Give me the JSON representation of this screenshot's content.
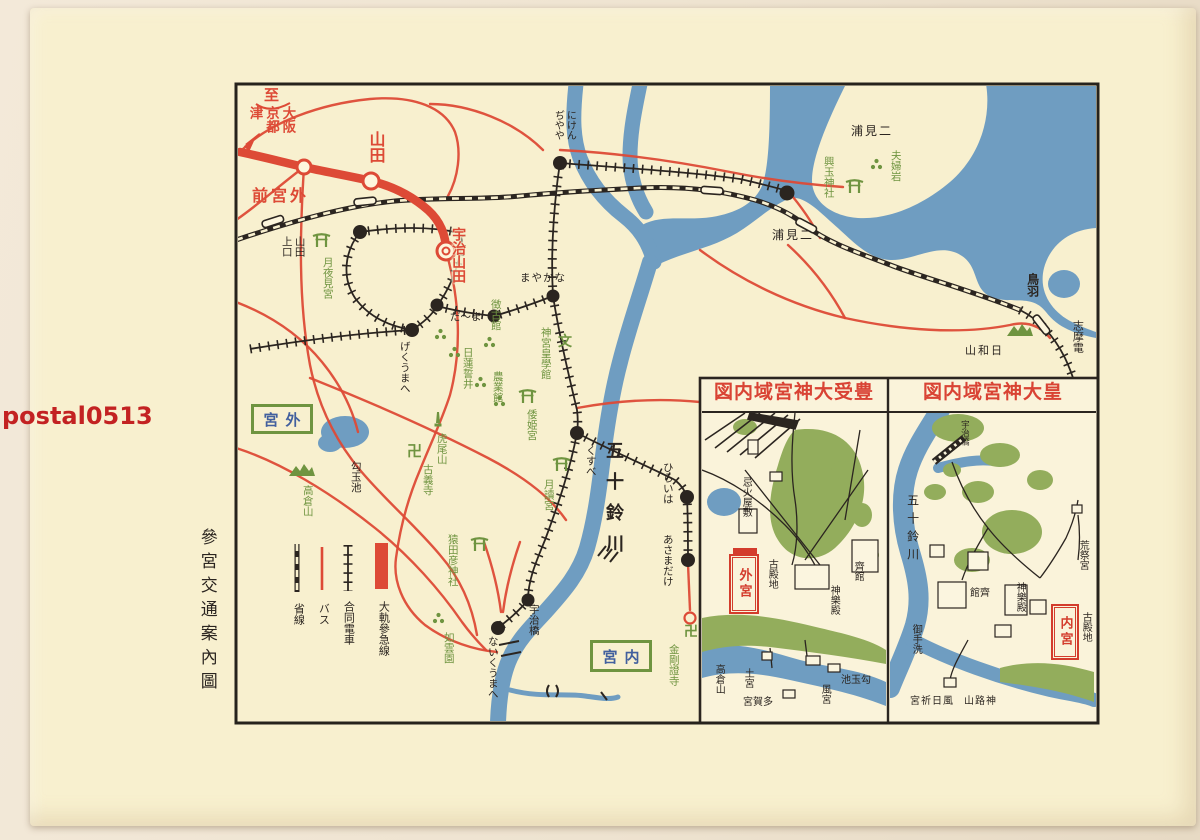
{
  "colors": {
    "black": "#2b2520",
    "red": "#dd4a36",
    "redlbl": "#d33c2c",
    "redtitle": "#d94334",
    "green": "#6f9440",
    "parkgreen": "#93ad5c",
    "blue": "#42609e",
    "water": "#6f9dc1",
    "cream": "#f8f0cf",
    "wm": "#c32222"
  },
  "postcard": {
    "labels": [
      {
        "name": "watermark",
        "text": "postal0513",
        "x": 2,
        "y": 402,
        "m": "h",
        "c": "wm",
        "s": 24,
        "b": 1,
        "f": "sans"
      },
      {
        "name": "map-doc-title",
        "text": "參宮交通案內圖",
        "x": 196,
        "y": 528,
        "m": "v",
        "c": "black",
        "s": 17,
        "ls": 7
      }
    ]
  },
  "legend": {
    "labels": [
      {
        "name": "legend-daiki-sankyu-line",
        "text": "大軌參急線",
        "x": 377,
        "y": 601,
        "m": "v",
        "c": "black",
        "s": 11
      },
      {
        "name": "legend-godo-densha",
        "text": "合同電車",
        "x": 342,
        "y": 601,
        "m": "v",
        "c": "black",
        "s": 11
      },
      {
        "name": "legend-bus",
        "text": "バス",
        "x": 317,
        "y": 603,
        "m": "v",
        "c": "black",
        "s": 11
      },
      {
        "name": "legend-shosen",
        "text": "省線",
        "x": 292,
        "y": 603,
        "m": "v",
        "c": "black",
        "s": 11
      }
    ]
  },
  "main_map": {
    "labels": [
      {
        "name": "dest-to",
        "text": "至",
        "x": 264,
        "y": 86,
        "m": "h",
        "c": "red",
        "s": 15,
        "b": 1
      },
      {
        "name": "dest-osaka-kyoto-tsu",
        "text": "大阪\n京都\n津",
        "x": 246,
        "y": 106,
        "m": "v",
        "c": "red",
        "s": 13.5,
        "b": 1
      },
      {
        "name": "sta-yamada-daiki",
        "text": "山田",
        "x": 366,
        "y": 131,
        "m": "v",
        "c": "red",
        "s": 16,
        "b": 1
      },
      {
        "name": "sta-gekumae",
        "text": "前宮外",
        "x": 252,
        "y": 186,
        "m": "h",
        "c": "red",
        "s": 16,
        "b": 1,
        "ls": 3
      },
      {
        "name": "sta-ujiyamada",
        "text": "宇治山田",
        "x": 449,
        "y": 227,
        "m": "v",
        "c": "red",
        "s": 14,
        "b": 1,
        "halo": 1
      },
      {
        "name": "sta-yamada-kamiguchi",
        "text": "山田\n上口",
        "x": 280,
        "y": 236,
        "m": "v",
        "c": "black",
        "s": 10.5
      },
      {
        "name": "shrine-tsukiyominomiya",
        "text": "月夜見宮",
        "x": 321,
        "y": 257,
        "m": "v",
        "c": "green",
        "s": 10.5
      },
      {
        "name": "sta-nikenjaya",
        "text": "にけん\nぢやや",
        "x": 551,
        "y": 110,
        "m": "v",
        "c": "black",
        "s": 10
      },
      {
        "name": "sta-nakayama",
        "text": "まやかな",
        "x": 520,
        "y": 272,
        "m": "h",
        "c": "black",
        "s": 10.5,
        "ls": 1
      },
      {
        "name": "sta-dama",
        "text": "だ〜ま",
        "x": 450,
        "y": 311,
        "m": "h",
        "c": "black",
        "s": 10.5
      },
      {
        "name": "sta-gekuumae-kana",
        "text": "げくうまへ",
        "x": 398,
        "y": 341,
        "m": "v",
        "c": "black",
        "s": 10.5
      },
      {
        "name": "poi-chokokan",
        "text": "徴古館",
        "x": 489,
        "y": 299,
        "m": "v",
        "c": "green",
        "s": 10.5
      },
      {
        "name": "poi-jingu-kogakkan",
        "text": "神宮皇學館",
        "x": 539,
        "y": 327,
        "m": "v",
        "c": "green",
        "s": 10.5
      },
      {
        "name": "icon-school-mark",
        "text": "文",
        "x": 558,
        "y": 334,
        "m": "h",
        "c": "green",
        "s": 14,
        "b": 1
      },
      {
        "name": "poi-nichiren-well",
        "text": "日蓮誓井",
        "x": 461,
        "y": 347,
        "m": "v",
        "c": "green",
        "s": 10.5
      },
      {
        "name": "poi-nogyokan",
        "text": "農業館",
        "x": 491,
        "y": 371,
        "m": "v",
        "c": "green",
        "s": 10.5
      },
      {
        "name": "shrine-yamatohime",
        "text": "倭姫宮",
        "x": 525,
        "y": 409,
        "m": "v",
        "c": "green",
        "s": 10.5
      },
      {
        "name": "shrine-tsukiyomi-naiku",
        "text": "月讀宮",
        "x": 542,
        "y": 479,
        "m": "v",
        "c": "green",
        "s": 10.5
      },
      {
        "name": "sta-kusube",
        "text": "くすべ",
        "x": 584,
        "y": 445,
        "m": "v",
        "c": "black",
        "s": 10.5
      },
      {
        "name": "river-isuzu-label",
        "text": "五十鈴川",
        "x": 602,
        "y": 441,
        "m": "v",
        "c": "black",
        "s": 18,
        "ls": 13,
        "b": 1
      },
      {
        "name": "sta-hiraiwa",
        "text": "ひらいは",
        "x": 661,
        "y": 462,
        "m": "v",
        "c": "black",
        "s": 10.5
      },
      {
        "name": "sta-asamadake",
        "text": "あさまだけ",
        "x": 661,
        "y": 534,
        "m": "v",
        "c": "black",
        "s": 10.5
      },
      {
        "name": "poi-toraoyama",
        "text": "虎尾山",
        "x": 435,
        "y": 433,
        "m": "v",
        "c": "green",
        "s": 10.5
      },
      {
        "name": "manji-kogiji",
        "text": "卍",
        "x": 407,
        "y": 442,
        "m": "h",
        "c": "green",
        "s": 15,
        "b": 1
      },
      {
        "name": "temple-kogiji",
        "text": "古義寺",
        "x": 421,
        "y": 464,
        "m": "v",
        "c": "green",
        "s": 10.5
      },
      {
        "name": "pond-magatamaike",
        "text": "勾玉池",
        "x": 349,
        "y": 461,
        "m": "v",
        "c": "black",
        "s": 10.5
      },
      {
        "name": "mtn-takakurayama",
        "text": "高倉山",
        "x": 301,
        "y": 485,
        "m": "v",
        "c": "green",
        "s": 10.5
      },
      {
        "name": "shrine-sarutahiko",
        "text": "猿田彦神社",
        "x": 446,
        "y": 534,
        "m": "v",
        "c": "green",
        "s": 10.5
      },
      {
        "name": "garden-jounen",
        "text": "如雲園",
        "x": 442,
        "y": 632,
        "m": "v",
        "c": "green",
        "s": 10.5
      },
      {
        "name": "sta-naikumae",
        "text": "ないくうまへ",
        "x": 486,
        "y": 636,
        "m": "v",
        "c": "black",
        "s": 10.5
      },
      {
        "name": "bridge-ujibashi",
        "text": "宇治橋",
        "x": 527,
        "y": 604,
        "m": "v",
        "c": "black",
        "s": 10.5
      },
      {
        "name": "manji-kongoshoji",
        "text": "卍",
        "x": 684,
        "y": 624,
        "m": "h",
        "c": "green",
        "s": 14,
        "b": 1
      },
      {
        "name": "temple-kongoshoji",
        "text": "金剛證寺",
        "x": 667,
        "y": 644,
        "m": "v",
        "c": "green",
        "s": 10.5
      },
      {
        "name": "coast-futamiura",
        "text": "浦見二",
        "x": 851,
        "y": 124,
        "m": "h",
        "c": "black",
        "s": 12,
        "ls": 2
      },
      {
        "name": "poi-meotoiwa",
        "text": "夫婦岩",
        "x": 889,
        "y": 150,
        "m": "v",
        "c": "green",
        "s": 10.5
      },
      {
        "name": "shrine-okitama",
        "text": "興玉神社",
        "x": 822,
        "y": 156,
        "m": "v",
        "c": "green",
        "s": 10.5
      },
      {
        "name": "sta-futamiura",
        "text": "浦見二",
        "x": 772,
        "y": 228,
        "m": "h",
        "c": "black",
        "s": 12,
        "ls": 2
      },
      {
        "name": "sta-toba",
        "text": "鳥羽",
        "x": 1025,
        "y": 273,
        "m": "v",
        "c": "black",
        "s": 12,
        "b": 1
      },
      {
        "name": "line-shimaden",
        "text": "志摩電",
        "x": 1071,
        "y": 320,
        "m": "v",
        "c": "black",
        "s": 11
      },
      {
        "name": "mtn-hiyoriyama",
        "text": "山和日",
        "x": 965,
        "y": 344,
        "m": "h",
        "c": "black",
        "s": 11,
        "ls": 2
      }
    ],
    "boxes": [
      {
        "name": "box-geku",
        "x": 251,
        "y": 404,
        "w": 62,
        "h": 30,
        "style": "green",
        "text": "宮外"
      },
      {
        "name": "box-naiku",
        "x": 590,
        "y": 640,
        "w": 62,
        "h": 32,
        "style": "green",
        "text": "宮内"
      }
    ],
    "icons": [
      {
        "t": "torii",
        "x": 312,
        "y": 232,
        "name": "torii-tsukiyominomiya"
      },
      {
        "t": "torii",
        "x": 470,
        "y": 536,
        "name": "torii-sarutahiko"
      },
      {
        "t": "torii",
        "x": 518,
        "y": 388,
        "name": "torii-yamatohime"
      },
      {
        "t": "torii",
        "x": 552,
        "y": 456,
        "name": "torii-tsukiyomi"
      },
      {
        "t": "torii",
        "x": 845,
        "y": 178,
        "name": "torii-okitama"
      },
      {
        "t": "mtn",
        "x": 288,
        "y": 462,
        "name": "mountain-takakurayama"
      },
      {
        "t": "mtn",
        "x": 1006,
        "y": 322,
        "name": "mountain-hiyoriyama"
      },
      {
        "t": "monument",
        "x": 433,
        "y": 411,
        "name": "monument-toraoyama"
      },
      {
        "t": "trees",
        "x": 434,
        "y": 328,
        "name": "trees"
      },
      {
        "t": "trees",
        "x": 448,
        "y": 346,
        "name": "trees"
      },
      {
        "t": "trees",
        "x": 483,
        "y": 336,
        "name": "trees"
      },
      {
        "t": "trees",
        "x": 474,
        "y": 376,
        "name": "trees"
      },
      {
        "t": "trees",
        "x": 493,
        "y": 395,
        "name": "trees"
      },
      {
        "t": "trees",
        "x": 432,
        "y": 612,
        "name": "trees"
      },
      {
        "t": "trees",
        "x": 870,
        "y": 158,
        "name": "trees-meotoiwa"
      }
    ]
  },
  "insets": {
    "left": {
      "title_label": {
        "name": "inset-title-toyouke-daijingu",
        "text": "図内域宮神大受豊",
        "x": 714,
        "y": 381,
        "m": "h",
        "c": "redtitle",
        "s": 19,
        "b": 1,
        "ls": 1
      },
      "box": {
        "name": "box-geku-inset",
        "x": 729,
        "y": 554,
        "w": 30,
        "h": 60,
        "style": "red",
        "text": "外宮"
      },
      "labels": [
        {
          "name": "ins-l-imibi-yashiki",
          "text": "忌火屋敷",
          "x": 739,
          "y": 477,
          "m": "v",
          "c": "black",
          "s": 10
        },
        {
          "name": "ins-l-kodenchi",
          "text": "古殿地",
          "x": 765,
          "y": 559,
          "m": "v",
          "c": "black",
          "s": 10
        },
        {
          "name": "ins-l-saikan",
          "text": "齊館",
          "x": 851,
          "y": 561,
          "m": "v",
          "c": "black",
          "s": 10
        },
        {
          "name": "ins-l-kaguraden",
          "text": "神樂殿",
          "x": 827,
          "y": 585,
          "m": "v",
          "c": "black",
          "s": 10
        },
        {
          "name": "ins-l-magatamaike",
          "text": "池玉勾",
          "x": 841,
          "y": 675,
          "m": "h",
          "c": "black",
          "s": 10
        },
        {
          "name": "ins-l-takakurayama",
          "text": "高倉山",
          "x": 712,
          "y": 664,
          "m": "v",
          "c": "black",
          "s": 10
        },
        {
          "name": "ins-l-tsuchinomiya",
          "text": "土宮",
          "x": 741,
          "y": 668,
          "m": "v",
          "c": "black",
          "s": 10
        },
        {
          "name": "ins-l-taganomiya",
          "text": "宮賀多",
          "x": 743,
          "y": 697,
          "m": "h",
          "c": "black",
          "s": 10
        },
        {
          "name": "ins-l-kazenomiya",
          "text": "風宮",
          "x": 818,
          "y": 684,
          "m": "v",
          "c": "black",
          "s": 10
        }
      ]
    },
    "right": {
      "title_label": {
        "name": "inset-title-kotai-jingu",
        "text": "図内域宮神大皇",
        "x": 923,
        "y": 381,
        "m": "h",
        "c": "redtitle",
        "s": 19,
        "b": 1,
        "ls": 1
      },
      "box": {
        "name": "box-naiku-inset",
        "x": 1051,
        "y": 604,
        "w": 28,
        "h": 56,
        "style": "red",
        "text": "内宮"
      },
      "labels": [
        {
          "name": "ins-r-ujibashi",
          "text": "宇治橋",
          "x": 959,
          "y": 420,
          "m": "v",
          "c": "black",
          "s": 8.5
        },
        {
          "name": "ins-r-isuzugawa",
          "text": "五十鈴川",
          "x": 905,
          "y": 494,
          "m": "v",
          "c": "black",
          "s": 12,
          "ls": 6
        },
        {
          "name": "ins-r-mitarashi",
          "text": "御手洗",
          "x": 909,
          "y": 624,
          "m": "v",
          "c": "black",
          "s": 10
        },
        {
          "name": "ins-r-saikan",
          "text": "館齊",
          "x": 970,
          "y": 588,
          "m": "h",
          "c": "black",
          "s": 10
        },
        {
          "name": "ins-r-kaguraden",
          "text": "神樂殿",
          "x": 1013,
          "y": 582,
          "m": "v",
          "c": "black",
          "s": 10
        },
        {
          "name": "ins-r-kodenchi",
          "text": "古殿地",
          "x": 1079,
          "y": 612,
          "m": "v",
          "c": "black",
          "s": 10
        },
        {
          "name": "ins-r-aramatsurinomiya",
          "text": "荒祭宮",
          "x": 1076,
          "y": 540,
          "m": "v",
          "c": "black",
          "s": 10
        },
        {
          "name": "ins-r-kazahinominomiya",
          "text": "宮祈日風",
          "x": 910,
          "y": 696,
          "m": "h",
          "c": "black",
          "s": 10,
          "ls": 1
        },
        {
          "name": "ins-r-kamijiyama",
          "text": "山路神",
          "x": 964,
          "y": 696,
          "m": "h",
          "c": "black",
          "s": 10,
          "ls": 1
        }
      ]
    }
  }
}
